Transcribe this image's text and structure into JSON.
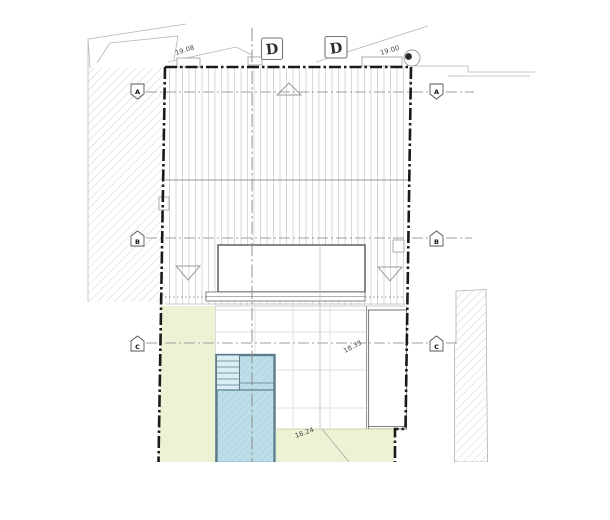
{
  "sections": {
    "markers": [
      {
        "label": "D"
      },
      {
        "label": "D"
      }
    ]
  },
  "grid": {
    "rows": [
      {
        "label": "A"
      },
      {
        "label": "B"
      },
      {
        "label": "C"
      }
    ]
  },
  "elevations": {
    "top_left": "19.08",
    "top_right": "19.00",
    "roof_terrace": "18.33",
    "garden": "16.24"
  },
  "colors": {
    "pool_fill": "#bedfe9",
    "pool_steps_fill": "#d9edf3",
    "pool_border": "#5e7d8b",
    "lawn": "#ecf3d4",
    "boundary": "#1a1a1a",
    "hatch": "#c4c4c4",
    "grid_line": "#9f9f9f"
  }
}
